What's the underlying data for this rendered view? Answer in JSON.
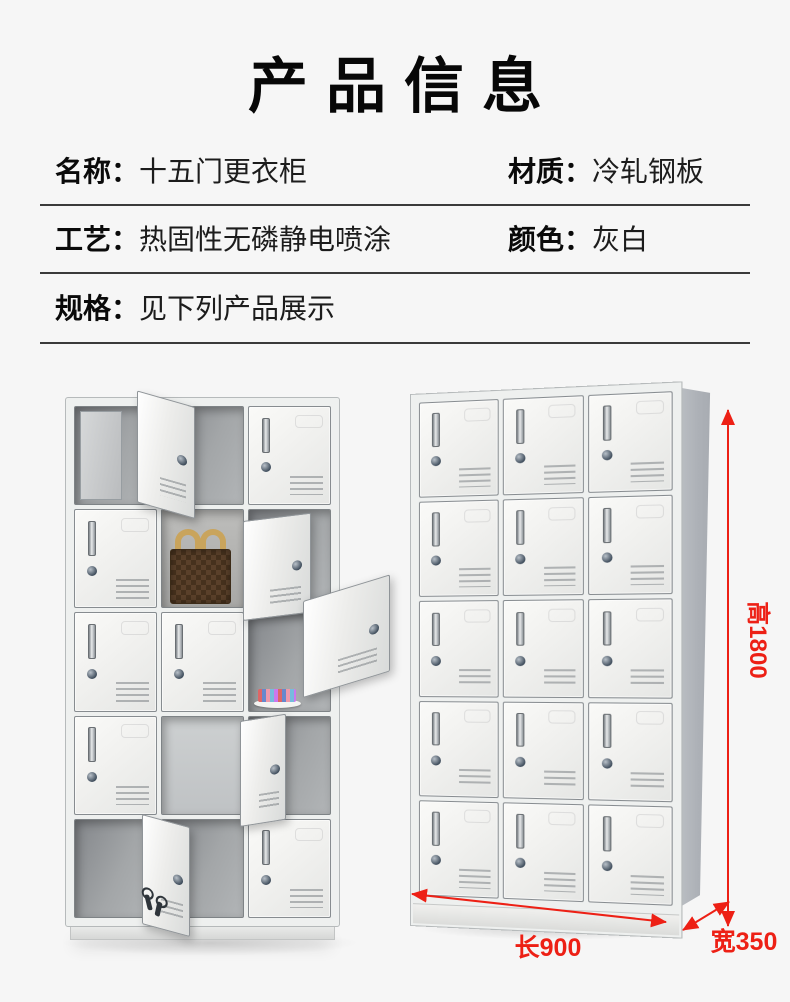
{
  "header": {
    "title": "产品信息"
  },
  "specs": [
    {
      "label": "名称：",
      "value": "十五门更衣柜"
    },
    {
      "label": "材质：",
      "value": "冷轧钢板"
    },
    {
      "label": "工艺：",
      "value": "热固性无磷静电喷涂"
    },
    {
      "label": "颜色：",
      "value": "灰白"
    },
    {
      "label": "规格：",
      "value": "见下列产品展示"
    }
  ],
  "dimensions": {
    "height": "高1800",
    "length": "长900",
    "width": "宽350"
  },
  "colors": {
    "background": "#f6f6f6",
    "text": "#0a0a0a",
    "accent_red": "#ed2015",
    "cabinet_white": "#eef0ef",
    "side_panel_gray": "#b0b4ba",
    "handbag_brown": "#4c351f",
    "handbag_handle_tan": "#c9a45c"
  },
  "lockers": {
    "left": {
      "rows": 5,
      "cols": 3,
      "cells": [
        {
          "r": 1,
          "c": 1,
          "state": "open",
          "interior": "dark",
          "inner_leaf": true
        },
        {
          "r": 1,
          "c": 2,
          "state": "open",
          "interior": "dark",
          "leaf": true
        },
        {
          "r": 1,
          "c": 3,
          "state": "closed"
        },
        {
          "r": 2,
          "c": 1,
          "state": "closed"
        },
        {
          "r": 2,
          "c": 2,
          "state": "open",
          "interior": "mid",
          "content": "handbag"
        },
        {
          "r": 2,
          "c": 3,
          "state": "open",
          "interior": "dark",
          "leaf": true
        },
        {
          "r": 3,
          "c": 1,
          "state": "closed"
        },
        {
          "r": 3,
          "c": 2,
          "state": "closed"
        },
        {
          "r": 3,
          "c": 3,
          "state": "open",
          "interior": "dark",
          "leaf": true,
          "content": "cosmetics-tray"
        },
        {
          "r": 4,
          "c": 1,
          "state": "closed"
        },
        {
          "r": 4,
          "c": 2,
          "state": "open",
          "interior": "light"
        },
        {
          "r": 4,
          "c": 3,
          "state": "open",
          "interior": "dark",
          "leaf": true
        },
        {
          "r": 5,
          "c": 1,
          "state": "open",
          "interior": "dark"
        },
        {
          "r": 5,
          "c": 2,
          "state": "open",
          "interior": "dark",
          "leaf": true,
          "leaf_content": "keys"
        },
        {
          "r": 5,
          "c": 3,
          "state": "closed"
        }
      ]
    },
    "right": {
      "rows": 5,
      "cols": 3,
      "all_closed": true
    }
  }
}
